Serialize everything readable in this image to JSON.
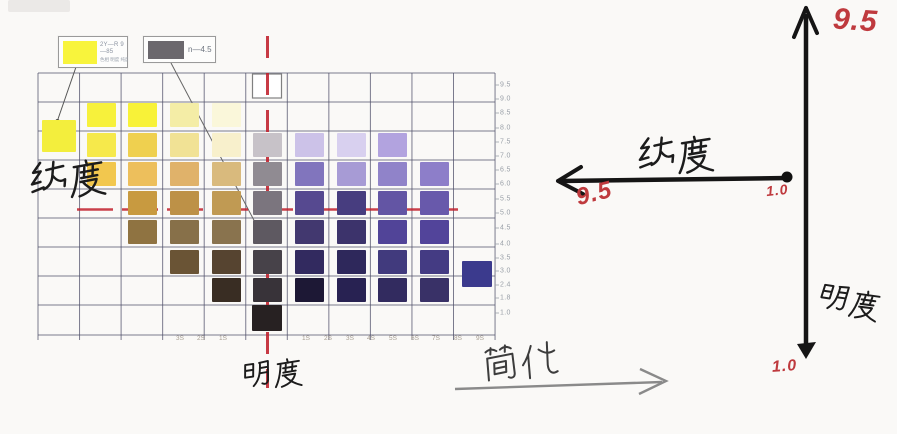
{
  "legend1": {
    "code": "2Y—R 9—85",
    "sub": "色相 明度 纯度",
    "swatch_color": "#f8f43c"
  },
  "legend2": {
    "code": "n—4.5",
    "swatch_color": "#6b686d"
  },
  "annotations": {
    "left_axis_label": "纯度",
    "bottom_axis_label": "明度",
    "simplify_label": "简化"
  },
  "right_diagram": {
    "h_axis_label": "纯度",
    "v_axis_label": "明度",
    "v_top_value": "9.5",
    "h_end_value": "9.5",
    "origin_value": "1.0",
    "v_bottom_value": "1.0"
  },
  "colors": {
    "red_line": "#c1202c",
    "grid": "#50506a",
    "handwriting_red": "#bf3a3e",
    "axis_black": "#151515",
    "simplify_arrow": "#8a8a8a"
  },
  "chart_data": {
    "type": "heatmap",
    "title": "",
    "value_axis_labels": [
      {
        "t": "9.5",
        "y": 85
      },
      {
        "t": "9.0",
        "y": 99
      },
      {
        "t": "8.5",
        "y": 113
      },
      {
        "t": "8.0",
        "y": 128
      },
      {
        "t": "7.5",
        "y": 142
      },
      {
        "t": "7.0",
        "y": 156
      },
      {
        "t": "6.5",
        "y": 170
      },
      {
        "t": "6.0",
        "y": 184
      },
      {
        "t": "5.5",
        "y": 199
      },
      {
        "t": "5.0",
        "y": 213
      },
      {
        "t": "4.5",
        "y": 228
      },
      {
        "t": "4.0",
        "y": 244
      },
      {
        "t": "3.5",
        "y": 258
      },
      {
        "t": "3.0",
        "y": 271
      },
      {
        "t": "2.4",
        "y": 285
      },
      {
        "t": "1.8",
        "y": 298
      },
      {
        "t": "1.0",
        "y": 313
      }
    ],
    "chroma_labels": [
      {
        "t": "3S",
        "x": 180
      },
      {
        "t": "2S",
        "x": 201
      },
      {
        "t": "1S",
        "x": 223
      },
      {
        "t": "1S",
        "x": 306
      },
      {
        "t": "2S",
        "x": 328
      },
      {
        "t": "3S",
        "x": 350
      },
      {
        "t": "4S",
        "x": 371
      },
      {
        "t": "5S",
        "x": 393
      },
      {
        "t": "6S",
        "x": 415
      },
      {
        "t": "7S",
        "x": 436
      },
      {
        "t": "8S",
        "x": 458
      },
      {
        "t": "9S",
        "x": 480
      }
    ],
    "swatches": [
      {
        "x": 101,
        "y": 115,
        "c": "#f7f13b"
      },
      {
        "x": 142,
        "y": 115,
        "c": "#f8f238"
      },
      {
        "x": 184,
        "y": 115,
        "c": "#f4eda6"
      },
      {
        "x": 226,
        "y": 115,
        "c": "#faf7da"
      },
      {
        "x": 59,
        "y": 136,
        "w": 34,
        "h": 32,
        "c": "#f3ee3d"
      },
      {
        "x": 101,
        "y": 145,
        "c": "#f6e94b"
      },
      {
        "x": 142,
        "y": 145,
        "c": "#efd04f"
      },
      {
        "x": 184,
        "y": 145,
        "c": "#f1e295"
      },
      {
        "x": 226,
        "y": 145,
        "c": "#f8f0cc"
      },
      {
        "x": 267,
        "y": 145,
        "c": "#c7c2c8"
      },
      {
        "x": 309,
        "y": 145,
        "c": "#ccc2e8"
      },
      {
        "x": 351,
        "y": 145,
        "c": "#d8d0ef"
      },
      {
        "x": 392,
        "y": 145,
        "c": "#b2a3df"
      },
      {
        "x": 101,
        "y": 174,
        "c": "#f2c74e"
      },
      {
        "x": 142,
        "y": 174,
        "c": "#edbf5c"
      },
      {
        "x": 184,
        "y": 174,
        "c": "#e0b26a"
      },
      {
        "x": 226,
        "y": 174,
        "c": "#d9ba7d"
      },
      {
        "x": 267,
        "y": 174,
        "c": "#908b92"
      },
      {
        "x": 309,
        "y": 174,
        "c": "#8175bd"
      },
      {
        "x": 351,
        "y": 174,
        "c": "#a79bd5"
      },
      {
        "x": 392,
        "y": 174,
        "c": "#9083c9"
      },
      {
        "x": 434,
        "y": 174,
        "c": "#8d7ec9"
      },
      {
        "x": 142,
        "y": 203,
        "c": "#c89a40"
      },
      {
        "x": 184,
        "y": 203,
        "c": "#bd9147"
      },
      {
        "x": 226,
        "y": 203,
        "c": "#c09a53"
      },
      {
        "x": 267,
        "y": 203,
        "c": "#7b757e"
      },
      {
        "x": 309,
        "y": 203,
        "c": "#564990"
      },
      {
        "x": 351,
        "y": 203,
        "c": "#473d7f"
      },
      {
        "x": 392,
        "y": 203,
        "c": "#6355a4"
      },
      {
        "x": 434,
        "y": 203,
        "c": "#6859ab"
      },
      {
        "x": 142,
        "y": 232,
        "c": "#8f7341"
      },
      {
        "x": 184,
        "y": 232,
        "c": "#877049"
      },
      {
        "x": 226,
        "y": 232,
        "c": "#89734e"
      },
      {
        "x": 267,
        "y": 232,
        "c": "#5e5961"
      },
      {
        "x": 309,
        "y": 232,
        "c": "#42386f"
      },
      {
        "x": 351,
        "y": 232,
        "c": "#3c336b"
      },
      {
        "x": 392,
        "y": 232,
        "c": "#514498"
      },
      {
        "x": 434,
        "y": 232,
        "c": "#52449a"
      },
      {
        "x": 184,
        "y": 262,
        "c": "#6a5435"
      },
      {
        "x": 226,
        "y": 262,
        "c": "#564430"
      },
      {
        "x": 267,
        "y": 262,
        "c": "#474249"
      },
      {
        "x": 309,
        "y": 262,
        "c": "#322a5f"
      },
      {
        "x": 351,
        "y": 262,
        "c": "#2e285b"
      },
      {
        "x": 392,
        "y": 262,
        "c": "#413a7d"
      },
      {
        "x": 434,
        "y": 262,
        "c": "#443b83"
      },
      {
        "x": 477,
        "y": 274,
        "w": 30,
        "h": 26,
        "c": "#3b3a8d"
      },
      {
        "x": 226,
        "y": 290,
        "c": "#392d23"
      },
      {
        "x": 267,
        "y": 290,
        "c": "#383339"
      },
      {
        "x": 309,
        "y": 290,
        "c": "#1d1835"
      },
      {
        "x": 351,
        "y": 290,
        "c": "#282252"
      },
      {
        "x": 392,
        "y": 290,
        "c": "#322b5f"
      },
      {
        "x": 434,
        "y": 290,
        "c": "#393167"
      },
      {
        "x": 267,
        "y": 318,
        "w": 30,
        "h": 26,
        "c": "#272122"
      }
    ]
  }
}
